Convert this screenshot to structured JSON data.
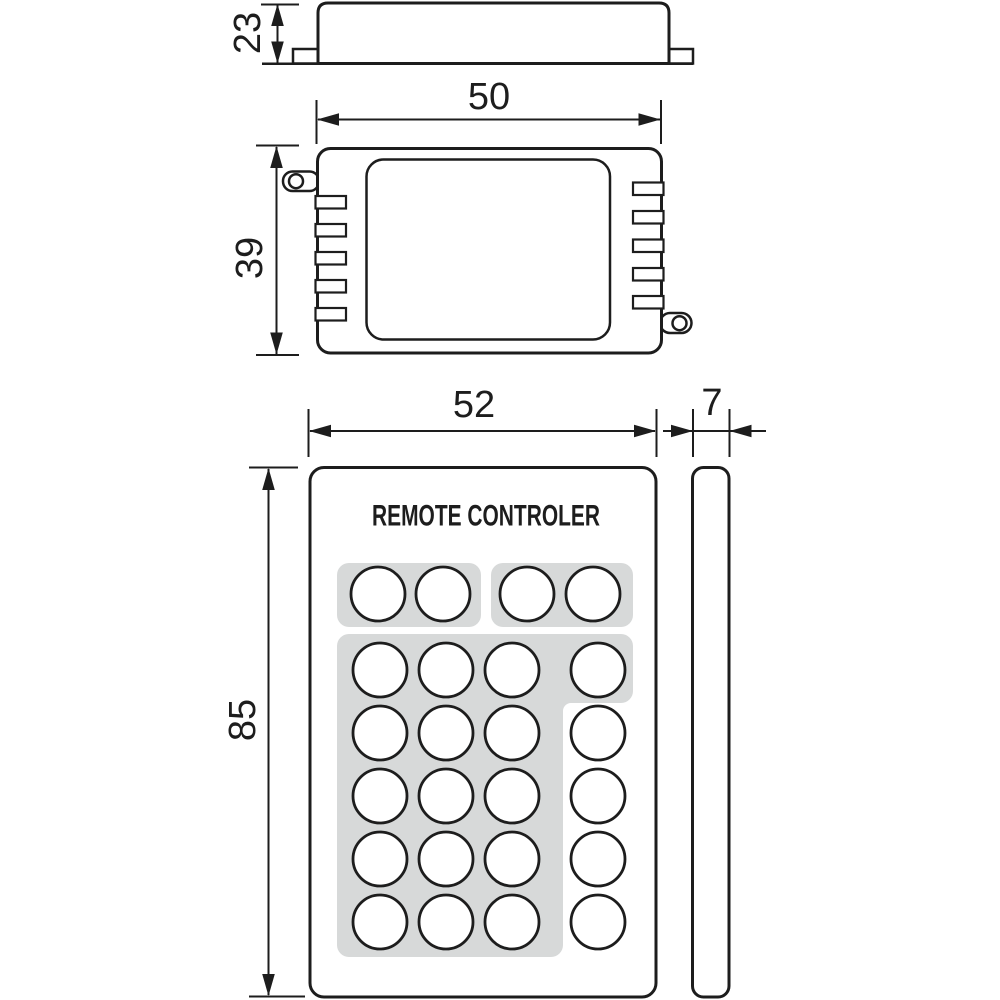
{
  "colors": {
    "line": "#1d1d1d",
    "pad_fill": "#d7d9d9",
    "background": "#ffffff"
  },
  "views": {
    "receiver_side": {
      "height_dim": "23"
    },
    "receiver_top": {
      "width_dim": "50",
      "height_dim": "39",
      "vent_slots_per_side": 5,
      "mounting_ears": 2
    },
    "remote_front": {
      "title": "REMOTE CONTROLER",
      "width_dim": "52",
      "height_dim": "85",
      "button_count": 24
    },
    "remote_side": {
      "width_dim": "7"
    }
  },
  "buttons": {
    "radius": 27,
    "top_row": {
      "y": 594,
      "xs": [
        378,
        443,
        527,
        593
      ]
    },
    "grid": {
      "row_ys": [
        670,
        733,
        796,
        859,
        922
      ],
      "col_xs": [
        380,
        446,
        512,
        598
      ]
    }
  }
}
